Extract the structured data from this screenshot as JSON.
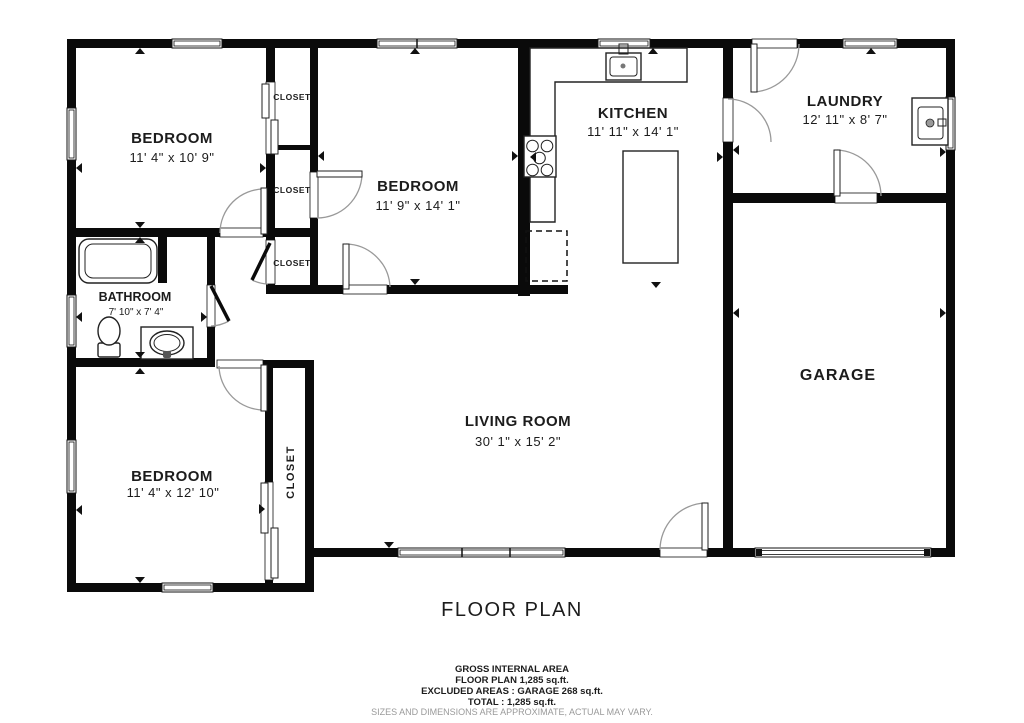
{
  "title": "FLOOR PLAN",
  "rooms": {
    "bedroom_top_left": {
      "label": "BEDROOM",
      "dims": "11' 4\" x 10' 9\""
    },
    "bedroom_middle": {
      "label": "BEDROOM",
      "dims": "11' 9\" x 14' 1\""
    },
    "bedroom_bottom_left": {
      "label": "BEDROOM",
      "dims": "11' 4\" x 12' 10\""
    },
    "kitchen": {
      "label": "KITCHEN",
      "dims": "11' 11\" x 14' 1\""
    },
    "laundry": {
      "label": "LAUNDRY",
      "dims": "12' 11\" x 8' 7\""
    },
    "bathroom": {
      "label": "BATHROOM",
      "dims": "7' 10\" x 7' 4\""
    },
    "living_room": {
      "label": "LIVING ROOM",
      "dims": "30' 1\" x 15' 2\""
    },
    "garage": {
      "label": "GARAGE"
    },
    "closet_top": {
      "label": "CLOSET"
    },
    "closet_middle": {
      "label": "CLOSET"
    },
    "closet_hall": {
      "label": "CLOSET"
    },
    "closet_bedroom3": {
      "label": "CLOSET"
    }
  },
  "footer": {
    "line1": "GROSS INTERNAL AREA",
    "line2": "FLOOR PLAN 1,285 sq.ft.",
    "line3": "EXCLUDED AREAS :  GARAGE 268 sq.ft.",
    "line4": "TOTAL :  1,285 sq.ft.",
    "disclaimer": "SIZES AND DIMENSIONS ARE APPROXIMATE, ACTUAL MAY VARY."
  },
  "colors": {
    "wall": "#0a0a0a",
    "text": "#1c1c1c",
    "muted_text": "#9a9a9a",
    "door_arc": "#999999",
    "background": "#ffffff"
  }
}
